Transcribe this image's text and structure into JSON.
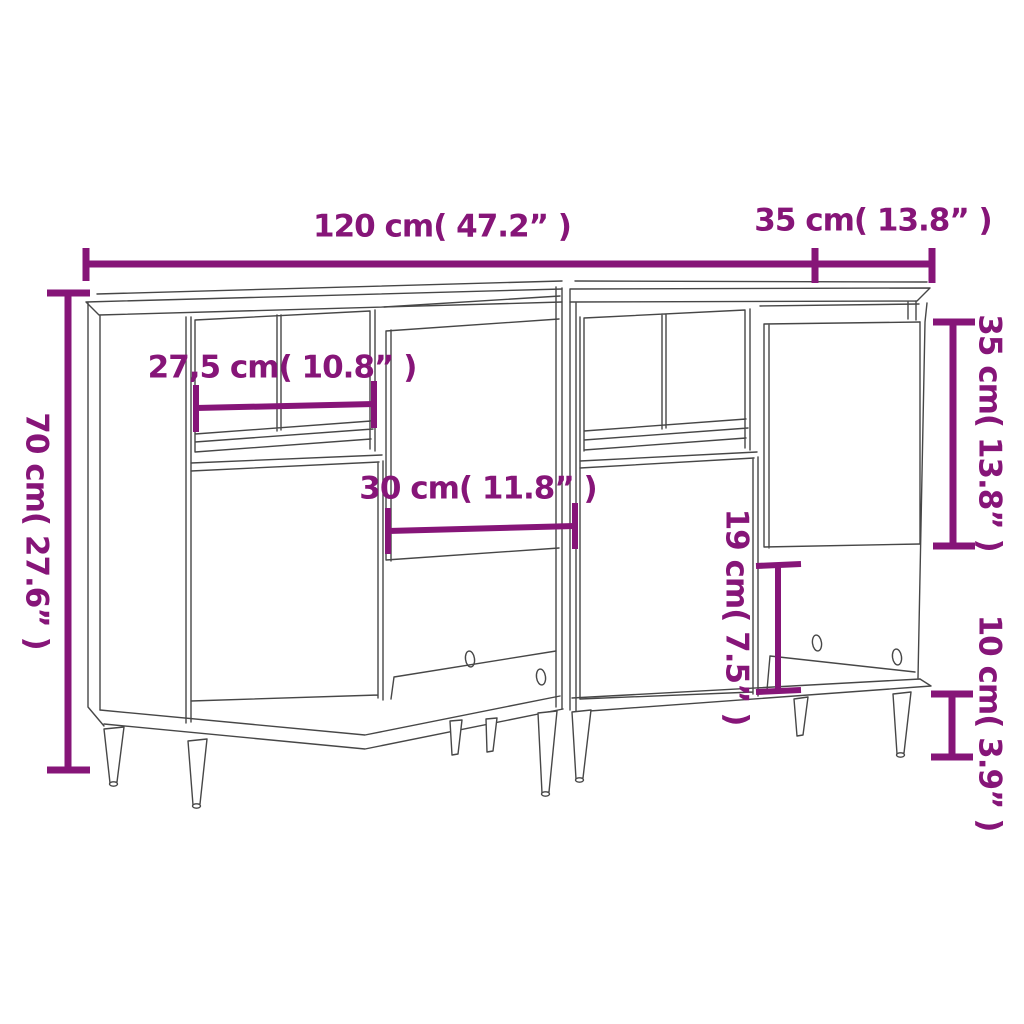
{
  "page": {
    "background": "#ffffff",
    "accent_color": "#861578",
    "line_color": "#474747",
    "subject": "two sideboards line drawing with dimension annotations"
  },
  "labels": {
    "width_total": "120 cm( 47.2” )",
    "depth": "35 cm( 13.8” )",
    "height": "70 cm( 27.6” )",
    "shelf_width": "27,5 cm( 10.8” )",
    "door_width": "30 cm( 11.8” )",
    "compartment_height": "19 cm( 7.5” )",
    "door_height": "35 cm( 13.8” )",
    "leg_height": "10 cm( 3.9” )"
  }
}
